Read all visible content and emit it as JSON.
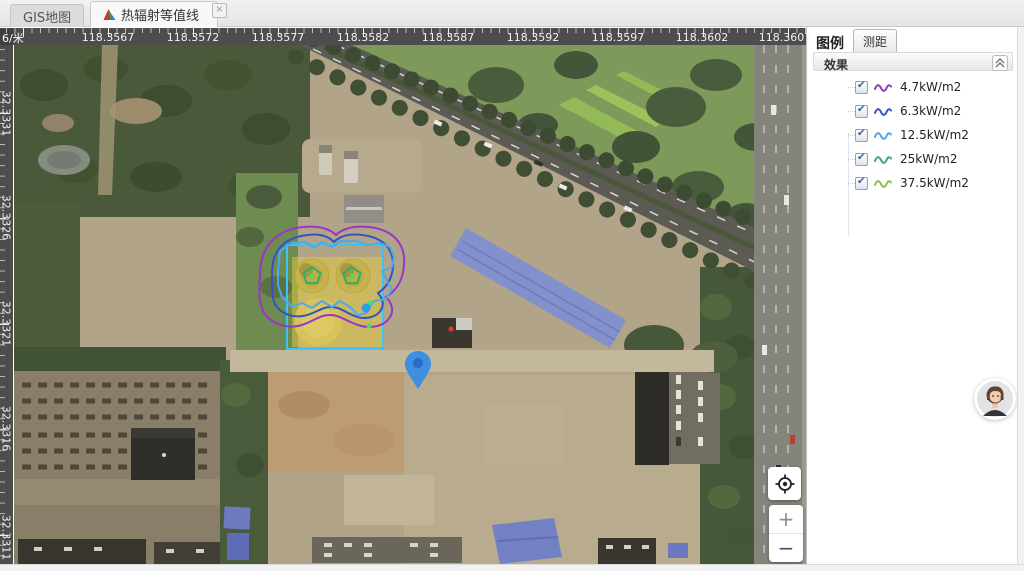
{
  "tab_bar": {
    "tabs": [
      {
        "label": "GIS地图",
        "active": false
      },
      {
        "label": "热辐射等值线",
        "active": true
      }
    ],
    "close_icon": "×"
  },
  "map": {
    "scale_label": "6/米",
    "top_ruler_labels": [
      "118.3567",
      "118.3572",
      "118.3577",
      "118.3582",
      "118.3587",
      "118.3592",
      "118.3597",
      "118.3602",
      "118.3607"
    ],
    "left_ruler_labels": [
      "32.3331",
      "32.3326",
      "32.3321",
      "32.3316",
      "32.3311"
    ],
    "zoom_in_label": "+",
    "zoom_out_label": "−"
  },
  "sidebar": {
    "legend_title": "图例",
    "measure_button_label": "测距",
    "effects_section_title": "效果",
    "legend_items": [
      {
        "label": "4.7kW/m2",
        "color": "#8a3fc6",
        "checked": true
      },
      {
        "label": "6.3kW/m2",
        "color": "#3a55c8",
        "checked": true
      },
      {
        "label": "12.5kW/m2",
        "color": "#4da6ea",
        "checked": true
      },
      {
        "label": "25kW/m2",
        "color": "#3fa873",
        "checked": true
      },
      {
        "label": "37.5kW/m2",
        "color": "#8cc044",
        "checked": true
      }
    ]
  },
  "overlay": {
    "zone_fill": "#e7cb3a",
    "zone_outline": "#3fc3f2",
    "pin_color": "#3e8ee2",
    "contour_colors": {
      "kw47": "#9a35c8",
      "kw63": "#3452c4",
      "kw125": "#49ace8",
      "kw25": "#2fae62",
      "kw375": "#3de45f"
    }
  }
}
